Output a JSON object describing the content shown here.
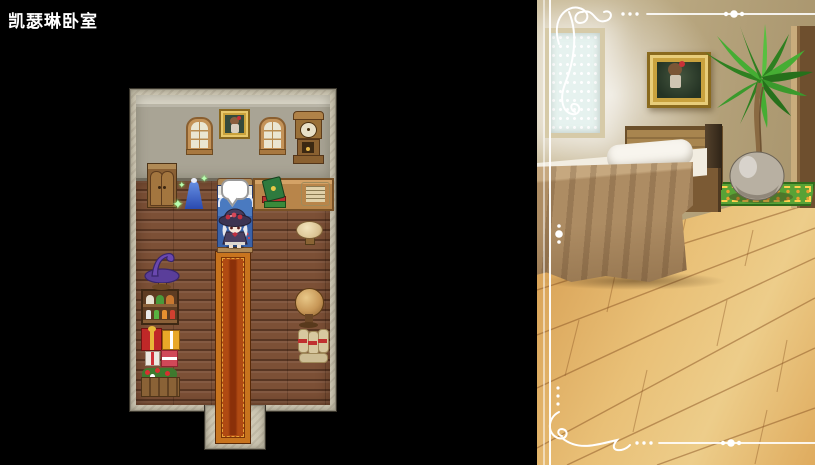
{
  "title": "凯瑟琳卧室",
  "map": {
    "name": "room-map",
    "wall_items": [
      "wooden-cabinet",
      "arched-window",
      "framed-portrait",
      "arched-window",
      "grandfather-clock"
    ],
    "floor_items": [
      "dress-mannequin",
      "sparkle-effect",
      "bed",
      "speech-bubble",
      "witch-hat-character",
      "desk-with-books",
      "open-scroll",
      "stool",
      "witch-hat-on-stand",
      "figurine-shelf",
      "gift-boxes",
      "flower-planter",
      "globe",
      "scroll-bundles",
      "red-carpet"
    ],
    "speech_bubble_text": ""
  },
  "illustration": {
    "name": "bedroom-artwork",
    "items": [
      "bright-lattice-window",
      "framed-portrait",
      "potted-palm-plant",
      "wooden-door-panel",
      "single-bed",
      "white-pillow",
      "green-patterned-rug",
      "wooden-plank-floor",
      "white-ornamental-border"
    ]
  },
  "sparkle_glyph": "✦",
  "colors": {
    "background": "#000000",
    "title_text": "#ffffff",
    "map_stone_border": "#cec8b4",
    "map_wall": "#a9a495",
    "map_floor": "#7c5036",
    "carpet_border": "#c8741e",
    "carpet_center": "#b04a12",
    "bed_blue": "#4a7ac0",
    "illustration_wall": "#b8a67f",
    "illustration_floor": "#e0b066",
    "rug_green": "#58a236",
    "flourish": "#ffffff"
  }
}
